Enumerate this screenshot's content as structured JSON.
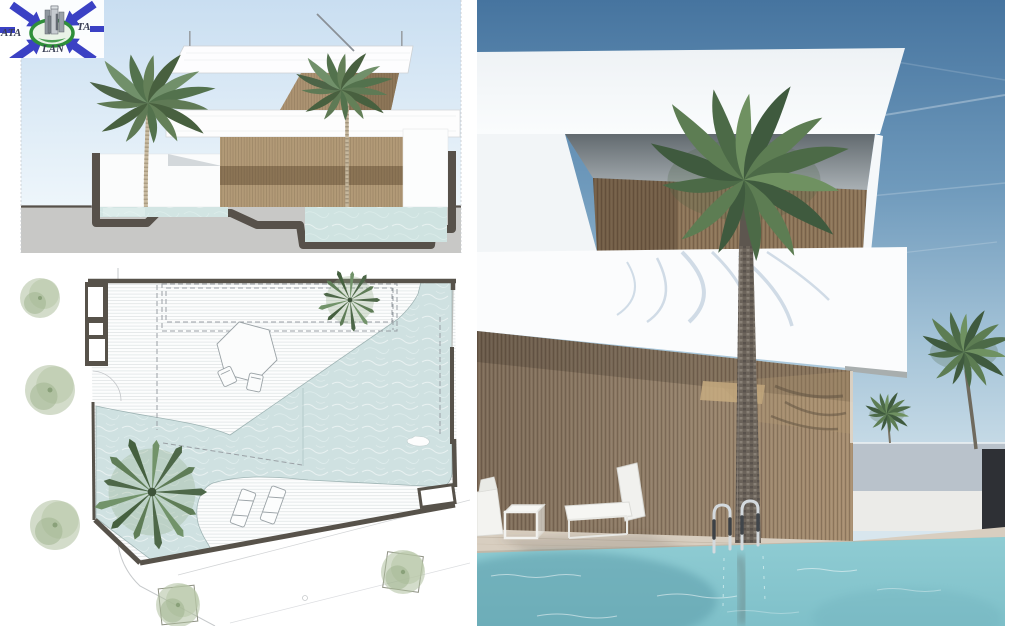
{
  "board": {
    "logo": {
      "fragment_left": "ATA",
      "fragment_right": "TA",
      "fragment_bottom": "LAN"
    },
    "panels": {
      "top_left": "section-elevation-drawing",
      "bottom_left": "site-plan-drawing",
      "right": "exterior-photorealistic-render"
    },
    "palette": {
      "paper": "#ffffff",
      "section-sky-top": "#c9def1",
      "section-sky-bottom": "#eef6fb",
      "section-ground": "#c8c8c6",
      "section-cut": "#57514a",
      "section-water": "#d2e5e3",
      "wood-light": "#b29a77",
      "wood-dark": "#8b7455",
      "plan-wall": "#57524a",
      "plan-water": "#cfe1e1",
      "plan-tree": "#aebf9e",
      "palm-green": "#4c6a47",
      "render-sky-top": "#46749f",
      "render-sky-horizon": "#d3e3ec",
      "render-wood": "#93806a",
      "render-wood-lit": "#c7ac80",
      "pool-water": "#8fccd3",
      "pool-water-dark": "#5f9fac",
      "deck": "#d8cec0",
      "dark-wall": "#2e3035",
      "logo-blue": "#3b41c4",
      "logo-green": "#2f8f3a",
      "logo-text": "#3a3f55"
    }
  }
}
